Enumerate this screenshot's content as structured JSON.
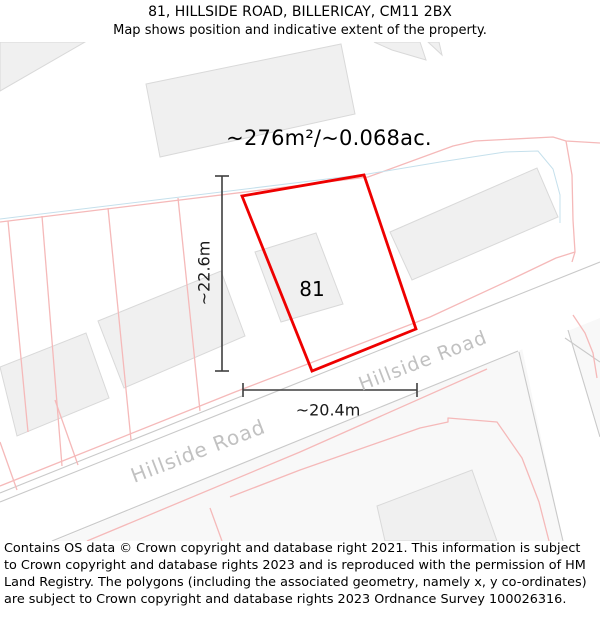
{
  "header": {
    "title": "81, HILLSIDE ROAD, BILLERICAY, CM11 2BX",
    "subtitle": "Map shows position and indicative extent of the property."
  },
  "map": {
    "area_label": "~276m²/~0.068ac.",
    "plot_number": "81",
    "dim_vertical": "~22.6m",
    "dim_horizontal": "~20.4m",
    "road_label_left": "Hillside Road",
    "road_label_right": "Hillside Road",
    "colors": {
      "plot_outline": "#ee0000",
      "parcel_line": "#f5b9b9",
      "water_line": "#c5e0ec",
      "road_line": "#c9c9c9",
      "building_fill": "#f0f0f0",
      "building_stroke": "#d9d9d9",
      "road_text": "#c1c1c1",
      "dimension_line": "#3f3f3f"
    }
  },
  "footer": {
    "copyright": "Contains OS data © Crown copyright and database right 2021. This information is subject to Crown copyright and database rights 2023 and is reproduced with the permission of HM Land Registry. The polygons (including the associated geometry, namely x, y co-ordinates) are subject to Crown copyright and database rights 2023 Ordnance Survey 100026316."
  }
}
